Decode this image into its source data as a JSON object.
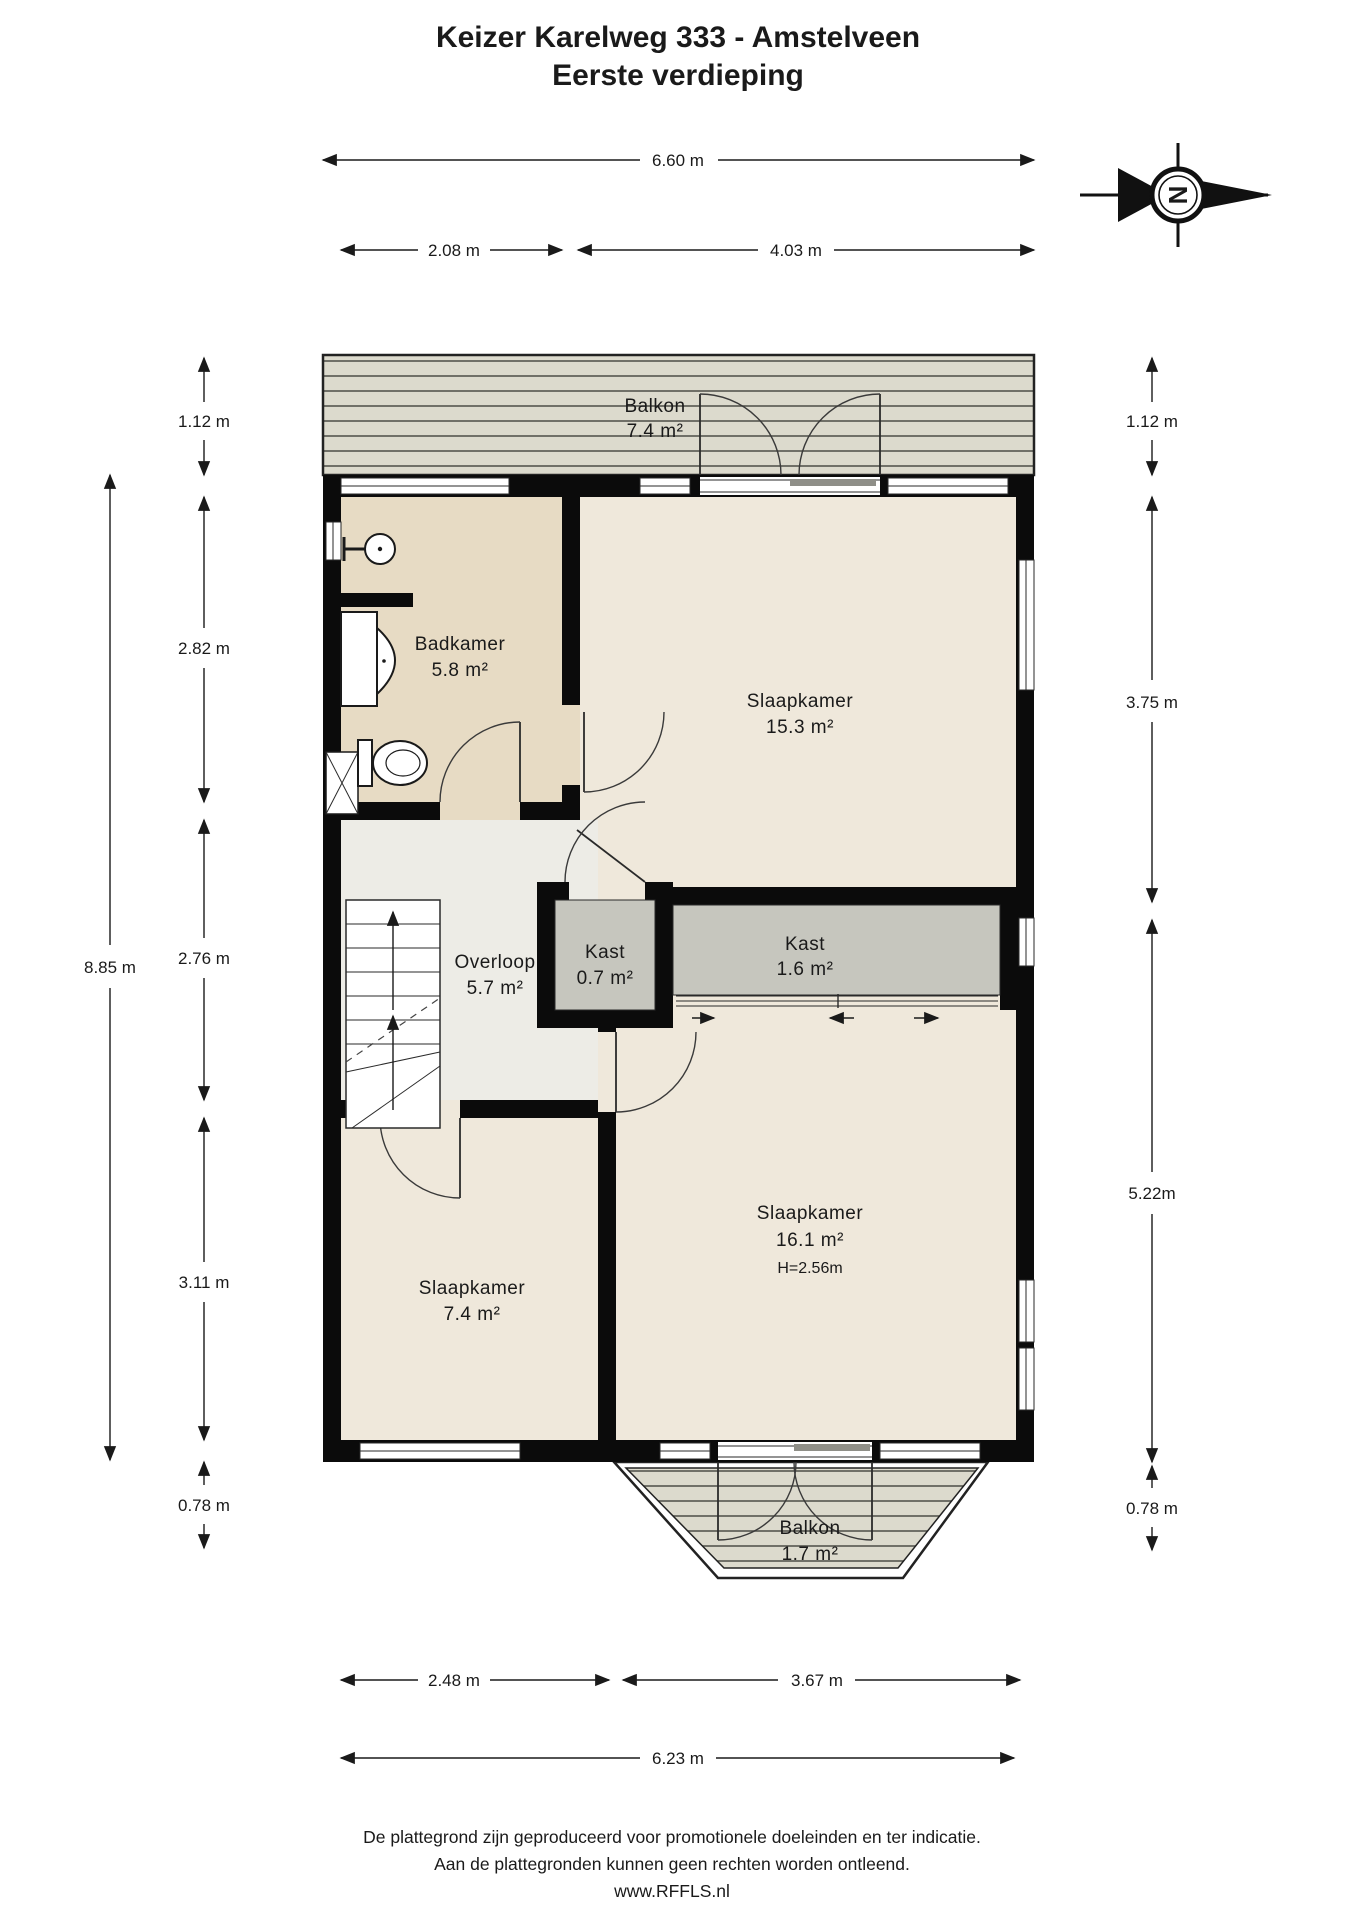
{
  "title": {
    "line1": "Keizer Karelweg 333 - Amstelveen",
    "line2": "Eerste verdieping"
  },
  "compass": {
    "letter": "N"
  },
  "rooms": {
    "balkon_top": {
      "name": "Balkon",
      "area": "7.4 m²"
    },
    "badkamer": {
      "name": "Badkamer",
      "area": "5.8 m²"
    },
    "slaapkamer_15": {
      "name": "Slaapkamer",
      "area": "15.3 m²"
    },
    "overloop": {
      "name": "Overloop",
      "area": "5.7 m²"
    },
    "kast_small": {
      "name": "Kast",
      "area": "0.7 m²"
    },
    "kast_large": {
      "name": "Kast",
      "area": "1.6 m²"
    },
    "slaapkamer_16": {
      "name": "Slaapkamer",
      "area": "16.1 m²",
      "height": "H=2.56m"
    },
    "slaapkamer_7": {
      "name": "Slaapkamer",
      "area": "7.4 m²"
    },
    "balkon_bottom": {
      "name": "Balkon",
      "area": "1.7 m²"
    }
  },
  "dimensions": {
    "top_total": "6.60 m",
    "top_left": "2.08 m",
    "top_right": "4.03 m",
    "left_1": "1.12 m",
    "left_2": "2.82 m",
    "left_3": "2.76 m",
    "left_4": "3.11 m",
    "left_5": "0.78 m",
    "left_total": "8.85 m",
    "right_1": "1.12 m",
    "right_2": "3.75 m",
    "right_3": "5.22m",
    "right_4": "0.78 m",
    "bottom_left": "2.48 m",
    "bottom_right": "3.67 m",
    "bottom_total": "6.23 m"
  },
  "footer": {
    "line1": "De plattegrond zijn geproduceerd voor promotionele doeleinden en ter indicatie.",
    "line2": "Aan de plattegronden kunnen geen rechten worden ontleend.",
    "line3": "www.RFFLS.nl"
  },
  "colors": {
    "floor_bedroom": "#efe8db",
    "floor_bathroom": "#e7dbc4",
    "floor_hall": "#edece6",
    "floor_closet": "#c6c6be",
    "deck": "#dcdacd",
    "wall": "#0b0b0b"
  }
}
